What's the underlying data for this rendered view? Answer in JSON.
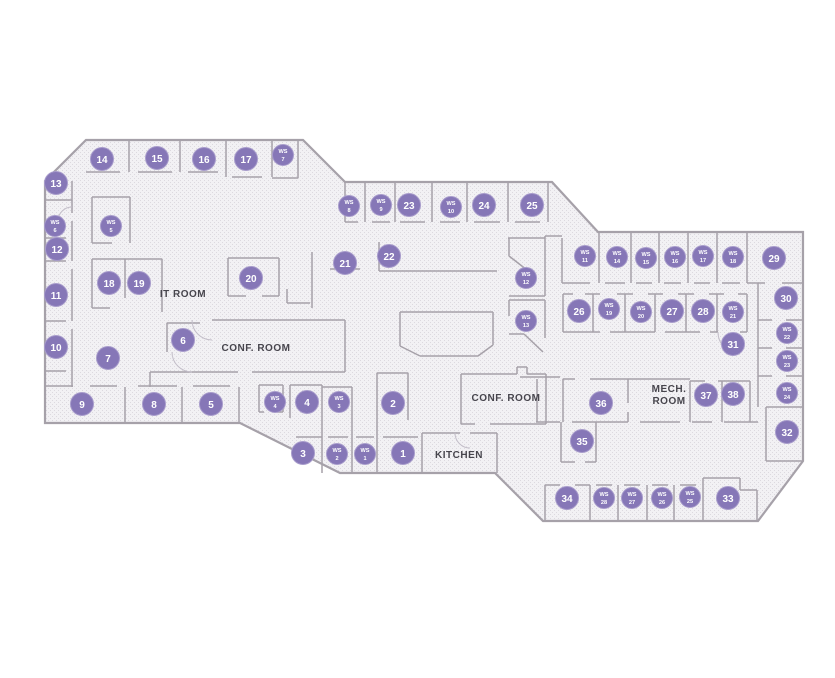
{
  "floor_plan": {
    "colors": {
      "floor": "#f2f1f4",
      "floor_dot": "#dcd9df",
      "wall": "#a6a1a9",
      "marker_fill": "#8677b7",
      "marker_ring": "#a79bcb",
      "marker_text": "#ffffff",
      "label_text": "#47454d"
    },
    "ws_prefix": "WS",
    "room_labels": [
      {
        "id": "it-room",
        "text": "IT ROOM",
        "x": 183,
        "y": 297
      },
      {
        "id": "conf-room-west",
        "text": "CONF. ROOM",
        "x": 256,
        "y": 351
      },
      {
        "id": "conf-room-east",
        "text": "CONF. ROOM",
        "x": 506,
        "y": 401
      },
      {
        "id": "kitchen",
        "text": "KITCHEN",
        "x": 459,
        "y": 458
      },
      {
        "id": "mech-room",
        "lines": [
          "MECH.",
          "ROOM"
        ],
        "x": 669,
        "y": 392
      }
    ],
    "offices": [
      {
        "n": "1",
        "x": 403,
        "y": 453
      },
      {
        "n": "2",
        "x": 393,
        "y": 403
      },
      {
        "n": "3",
        "x": 303,
        "y": 453
      },
      {
        "n": "4",
        "x": 307,
        "y": 402
      },
      {
        "n": "5",
        "x": 211,
        "y": 404
      },
      {
        "n": "6",
        "x": 183,
        "y": 340
      },
      {
        "n": "7",
        "x": 108,
        "y": 358
      },
      {
        "n": "8",
        "x": 154,
        "y": 404
      },
      {
        "n": "9",
        "x": 82,
        "y": 404
      },
      {
        "n": "10",
        "x": 56,
        "y": 347
      },
      {
        "n": "11",
        "x": 56,
        "y": 295
      },
      {
        "n": "12",
        "x": 57,
        "y": 249
      },
      {
        "n": "13",
        "x": 56,
        "y": 183
      },
      {
        "n": "14",
        "x": 102,
        "y": 159
      },
      {
        "n": "15",
        "x": 157,
        "y": 158
      },
      {
        "n": "16",
        "x": 204,
        "y": 159
      },
      {
        "n": "17",
        "x": 246,
        "y": 159
      },
      {
        "n": "18",
        "x": 109,
        "y": 283
      },
      {
        "n": "19",
        "x": 139,
        "y": 283
      },
      {
        "n": "20",
        "x": 251,
        "y": 278
      },
      {
        "n": "21",
        "x": 345,
        "y": 263
      },
      {
        "n": "22",
        "x": 389,
        "y": 256
      },
      {
        "n": "23",
        "x": 409,
        "y": 205
      },
      {
        "n": "24",
        "x": 484,
        "y": 205
      },
      {
        "n": "25",
        "x": 532,
        "y": 205
      },
      {
        "n": "26",
        "x": 579,
        "y": 311
      },
      {
        "n": "27",
        "x": 672,
        "y": 311
      },
      {
        "n": "28",
        "x": 703,
        "y": 311
      },
      {
        "n": "29",
        "x": 774,
        "y": 258
      },
      {
        "n": "30",
        "x": 786,
        "y": 298
      },
      {
        "n": "31",
        "x": 733,
        "y": 344
      },
      {
        "n": "32",
        "x": 787,
        "y": 432
      },
      {
        "n": "33",
        "x": 728,
        "y": 498
      },
      {
        "n": "34",
        "x": 567,
        "y": 498
      },
      {
        "n": "35",
        "x": 582,
        "y": 441
      },
      {
        "n": "36",
        "x": 601,
        "y": 403
      },
      {
        "n": "37",
        "x": 706,
        "y": 395
      },
      {
        "n": "38",
        "x": 733,
        "y": 394
      }
    ],
    "workstations": [
      {
        "n": "1",
        "x": 365,
        "y": 454
      },
      {
        "n": "2",
        "x": 337,
        "y": 454
      },
      {
        "n": "3",
        "x": 339,
        "y": 402
      },
      {
        "n": "4",
        "x": 275,
        "y": 402
      },
      {
        "n": "5",
        "x": 111,
        "y": 226
      },
      {
        "n": "6",
        "x": 55,
        "y": 226
      },
      {
        "n": "7",
        "x": 283,
        "y": 155
      },
      {
        "n": "8",
        "x": 349,
        "y": 206
      },
      {
        "n": "9",
        "x": 381,
        "y": 205
      },
      {
        "n": "10",
        "x": 451,
        "y": 207
      },
      {
        "n": "11",
        "x": 585,
        "y": 256
      },
      {
        "n": "12",
        "x": 526,
        "y": 278
      },
      {
        "n": "13",
        "x": 526,
        "y": 321
      },
      {
        "n": "14",
        "x": 617,
        "y": 257
      },
      {
        "n": "15",
        "x": 646,
        "y": 258
      },
      {
        "n": "16",
        "x": 675,
        "y": 257
      },
      {
        "n": "17",
        "x": 703,
        "y": 256
      },
      {
        "n": "18",
        "x": 733,
        "y": 257
      },
      {
        "n": "19",
        "x": 609,
        "y": 309
      },
      {
        "n": "20",
        "x": 641,
        "y": 312
      },
      {
        "n": "21",
        "x": 733,
        "y": 312
      },
      {
        "n": "22",
        "x": 787,
        "y": 333
      },
      {
        "n": "23",
        "x": 787,
        "y": 361
      },
      {
        "n": "24",
        "x": 787,
        "y": 393
      },
      {
        "n": "25",
        "x": 690,
        "y": 497
      },
      {
        "n": "26",
        "x": 662,
        "y": 498
      },
      {
        "n": "27",
        "x": 632,
        "y": 498
      },
      {
        "n": "28",
        "x": 604,
        "y": 498
      }
    ]
  }
}
